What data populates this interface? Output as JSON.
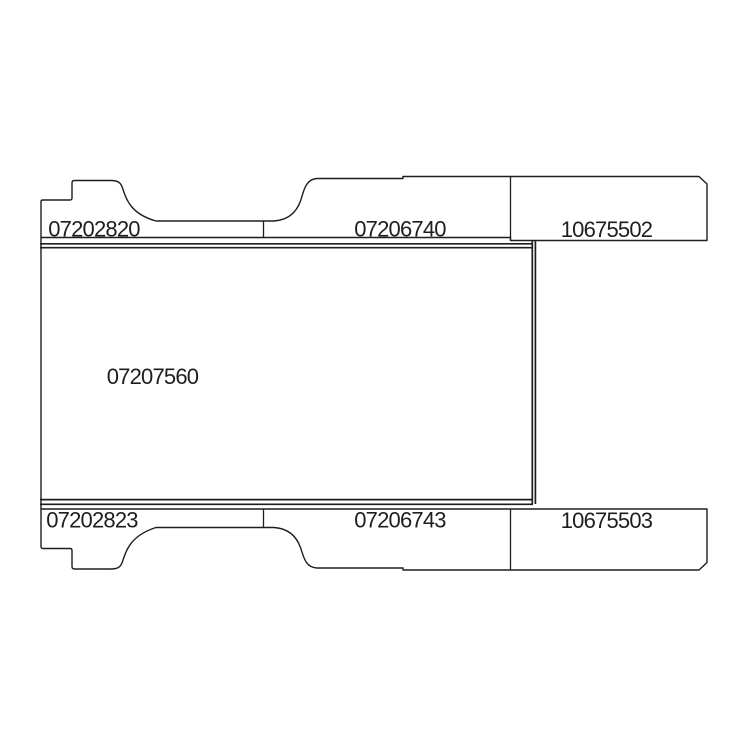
{
  "diagram": {
    "description": "panel parts layout line drawing",
    "background_color": "#ffffff",
    "line_color": "#1e1e1e",
    "parts": {
      "top_left": "07202820",
      "top_middle": "07206740",
      "top_right": "10675502",
      "center": "07207560",
      "bottom_left": "07202823",
      "bottom_middle": "07206743",
      "bottom_right": "10675503"
    }
  }
}
